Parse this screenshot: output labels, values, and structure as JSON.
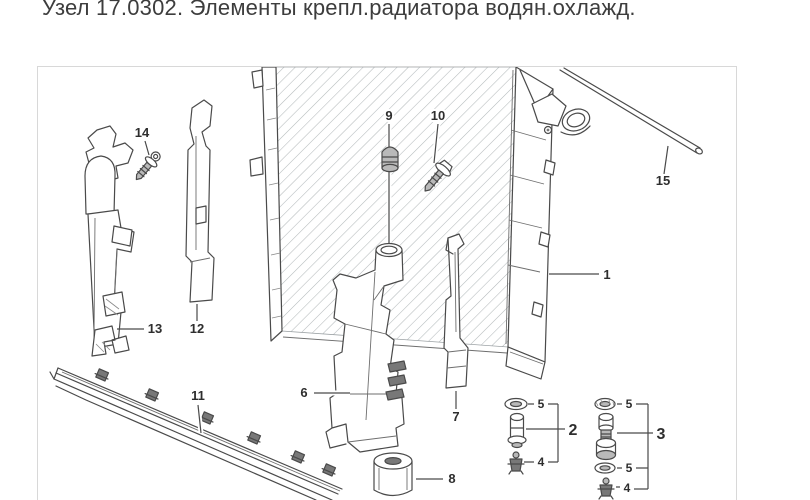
{
  "title": "Узел 17.0302. Элементы крепл.радиатора водян.охлажд.",
  "colors": {
    "line": "#4a4a4a",
    "hatch": "#b4b9bb",
    "frame_border": "#d8d8d8",
    "title_text": "#3d3d3d",
    "callout_text": "#2e2e2e"
  },
  "diagram": {
    "callouts": {
      "radiator": "1",
      "pin_left": "2",
      "pin_right": "3",
      "clip_left": "4",
      "clip_right": "4",
      "washer_left": "5",
      "washer_right_top": "5",
      "washer_right_bottom": "5",
      "bracket_center": "6",
      "bracket_thin": "7",
      "rubber_mount": "8",
      "grommet": "9",
      "screw_radiator": "10",
      "carrier_rail": "11",
      "bracket_side_right": "12",
      "bracket_side_left": "13",
      "screw_side": "14",
      "tube": "15"
    }
  }
}
